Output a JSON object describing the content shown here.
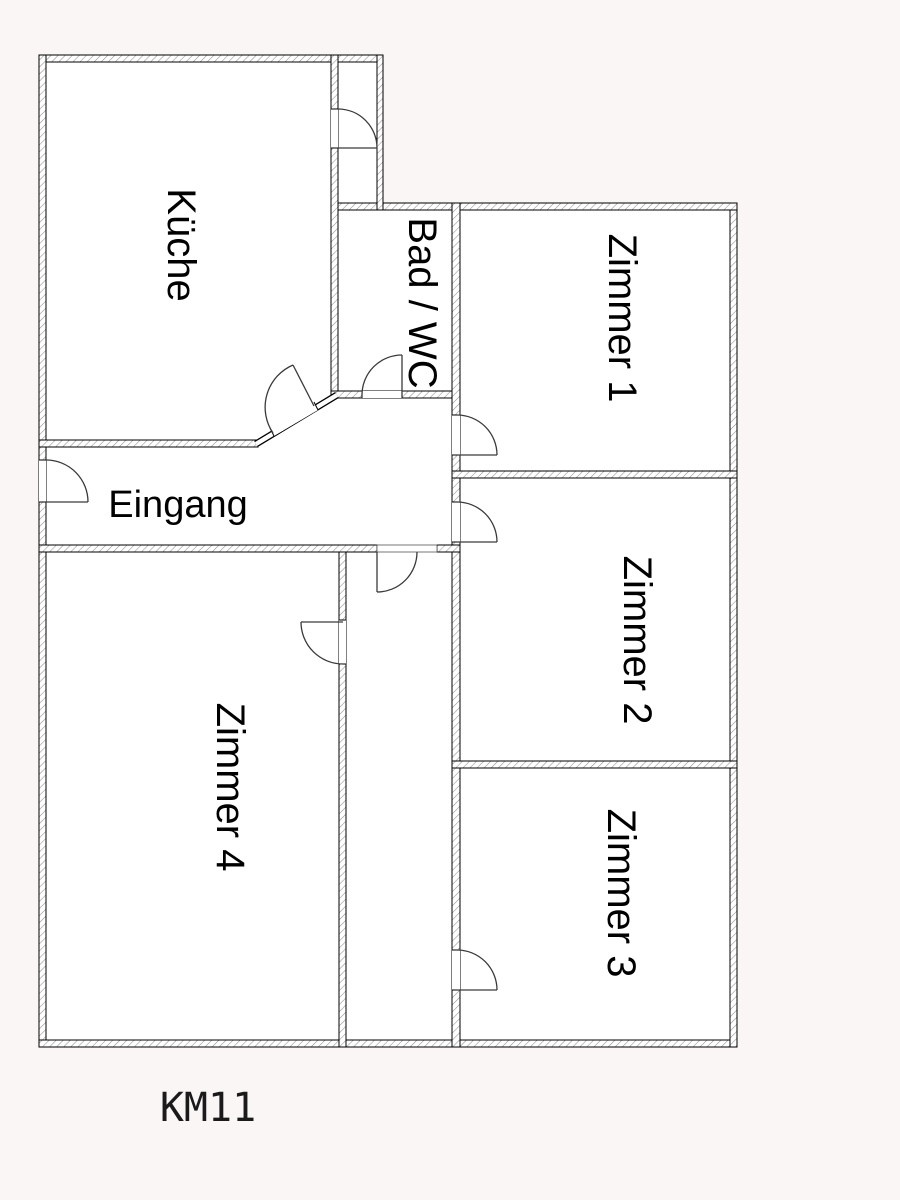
{
  "floorplan": {
    "code": "KM11",
    "colors": {
      "background": "#faf6f5",
      "plan_fill": "#ffffff",
      "wall_line": "#000000",
      "hatch_line": "#8f8f8f",
      "door_line": "#3a3a3a",
      "text": "#000000"
    },
    "rooms": [
      {
        "id": "kueche",
        "label": "Küche"
      },
      {
        "id": "bad-wc",
        "label": "Bad / WC"
      },
      {
        "id": "zimmer-1",
        "label": "Zimmer 1"
      },
      {
        "id": "zimmer-2",
        "label": "Zimmer 2"
      },
      {
        "id": "zimmer-3",
        "label": "Zimmer 3"
      },
      {
        "id": "zimmer-4",
        "label": "Zimmer 4"
      },
      {
        "id": "eingang",
        "label": "Eingang"
      }
    ]
  }
}
